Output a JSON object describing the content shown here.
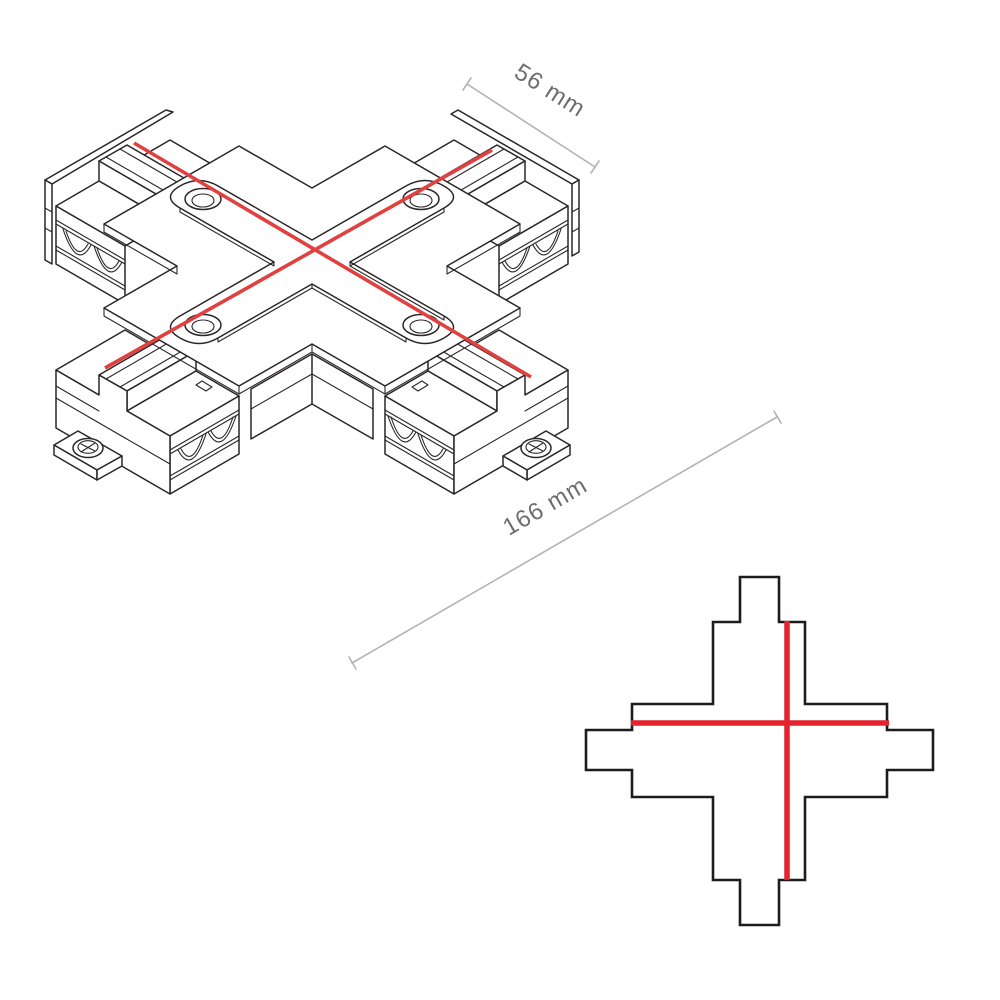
{
  "drawing": {
    "title": "x-connector-technical-drawing",
    "dimensions": {
      "width_label": "56 mm",
      "length_label": "166 mm"
    },
    "views": {
      "isometric": "x-connector-isometric-view",
      "profile": "x-connector-cross-section-profile"
    },
    "colors": {
      "accent_red": "#e6232d",
      "line_black": "#2b2627",
      "dimension_gray": "#b3b3b3",
      "text_gray": "#6e6e6e",
      "background": "#ffffff"
    }
  }
}
